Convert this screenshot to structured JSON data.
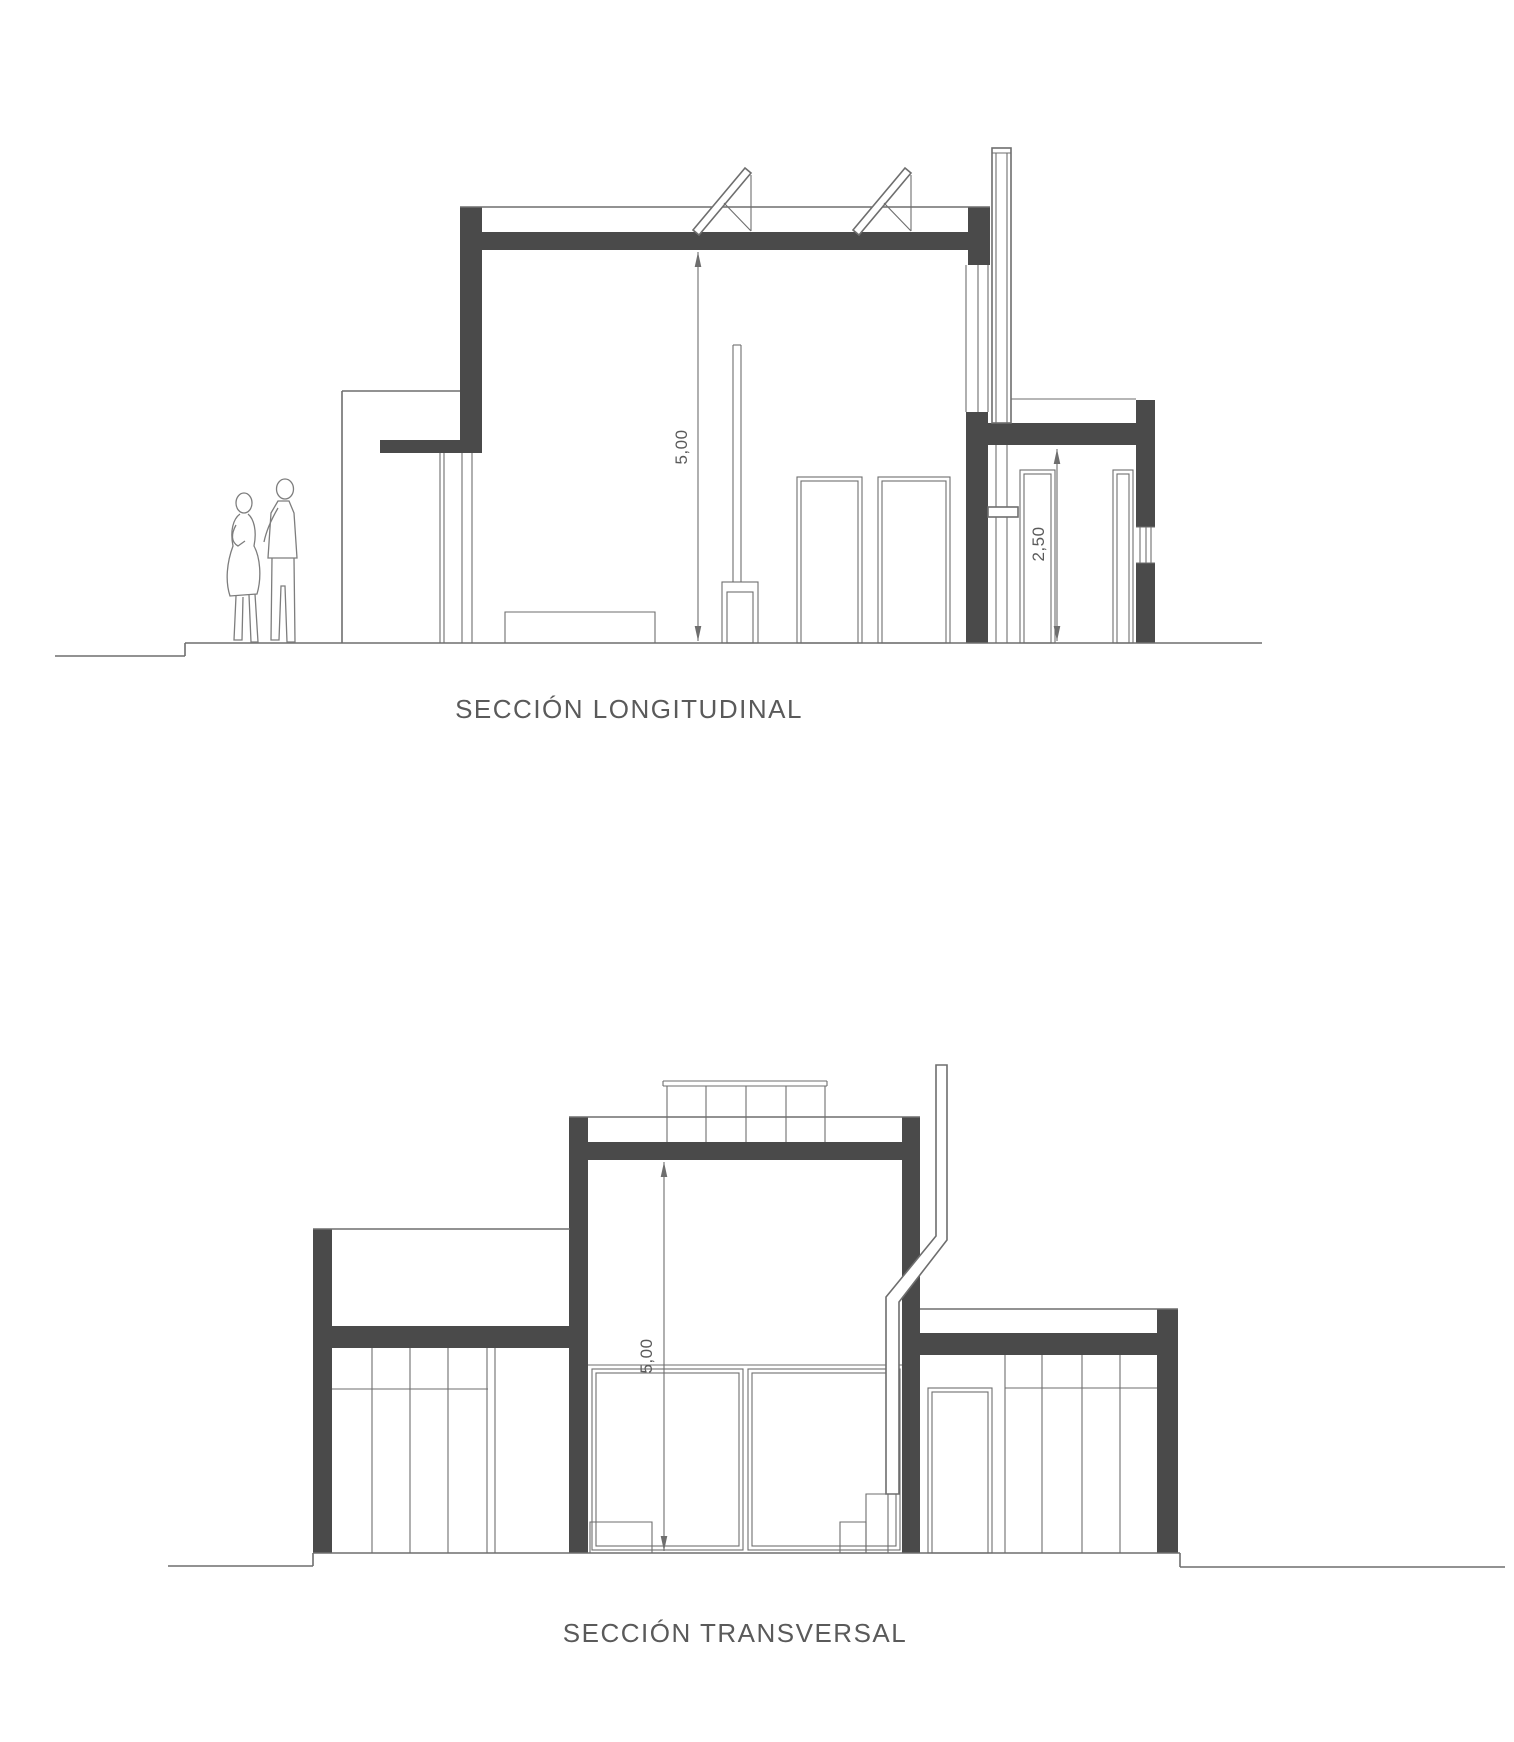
{
  "document": {
    "type": "architectural-section-drawing",
    "background": "#ffffff"
  },
  "colors": {
    "wall_fill": "#4a4a4a",
    "line": "#6e6e6e",
    "text": "#5a5a5a"
  },
  "sections": [
    {
      "id": "longitudinal",
      "title": "SECCIÓN LONGITUDINAL",
      "dimensions": [
        {
          "label": "5,00"
        },
        {
          "label": "2,50"
        }
      ],
      "icons": [
        "person-woman",
        "person-man",
        "solar-panel",
        "solar-panel",
        "chimney",
        "wood-stove",
        "bench"
      ]
    },
    {
      "id": "transversal",
      "title": "SECCIÓN TRANSVERSAL",
      "dimensions": [
        {
          "label": "5,00"
        }
      ],
      "icons": [
        "solar-panel-bank",
        "chimney-flue",
        "steps"
      ]
    }
  ]
}
